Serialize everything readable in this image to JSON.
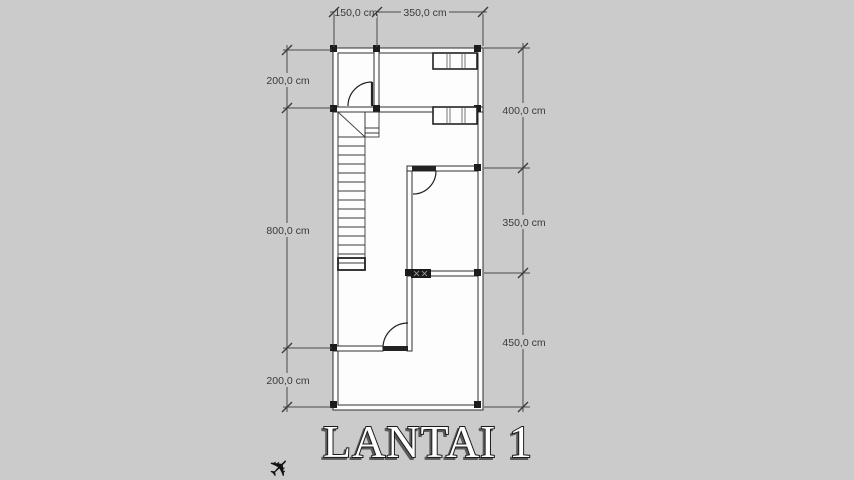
{
  "title": {
    "text": "LANTAI 1"
  },
  "dimensions": {
    "top": [
      "150,0 cm",
      "350,0 cm"
    ],
    "left": [
      "200,0 cm",
      "800,0 cm",
      "200,0 cm"
    ],
    "right": [
      "400,0 cm",
      "350,0 cm",
      "450,0 cm"
    ]
  },
  "icons": {
    "plane": "✈"
  },
  "colors": {
    "background": "#cbcbcb",
    "wall_line": "#2e2e2e",
    "room_fill": "#fdfdfd",
    "dimension_line": "#4a4a4a",
    "title_fill": "#ffffff",
    "title_outline": "#1a1a1a"
  }
}
